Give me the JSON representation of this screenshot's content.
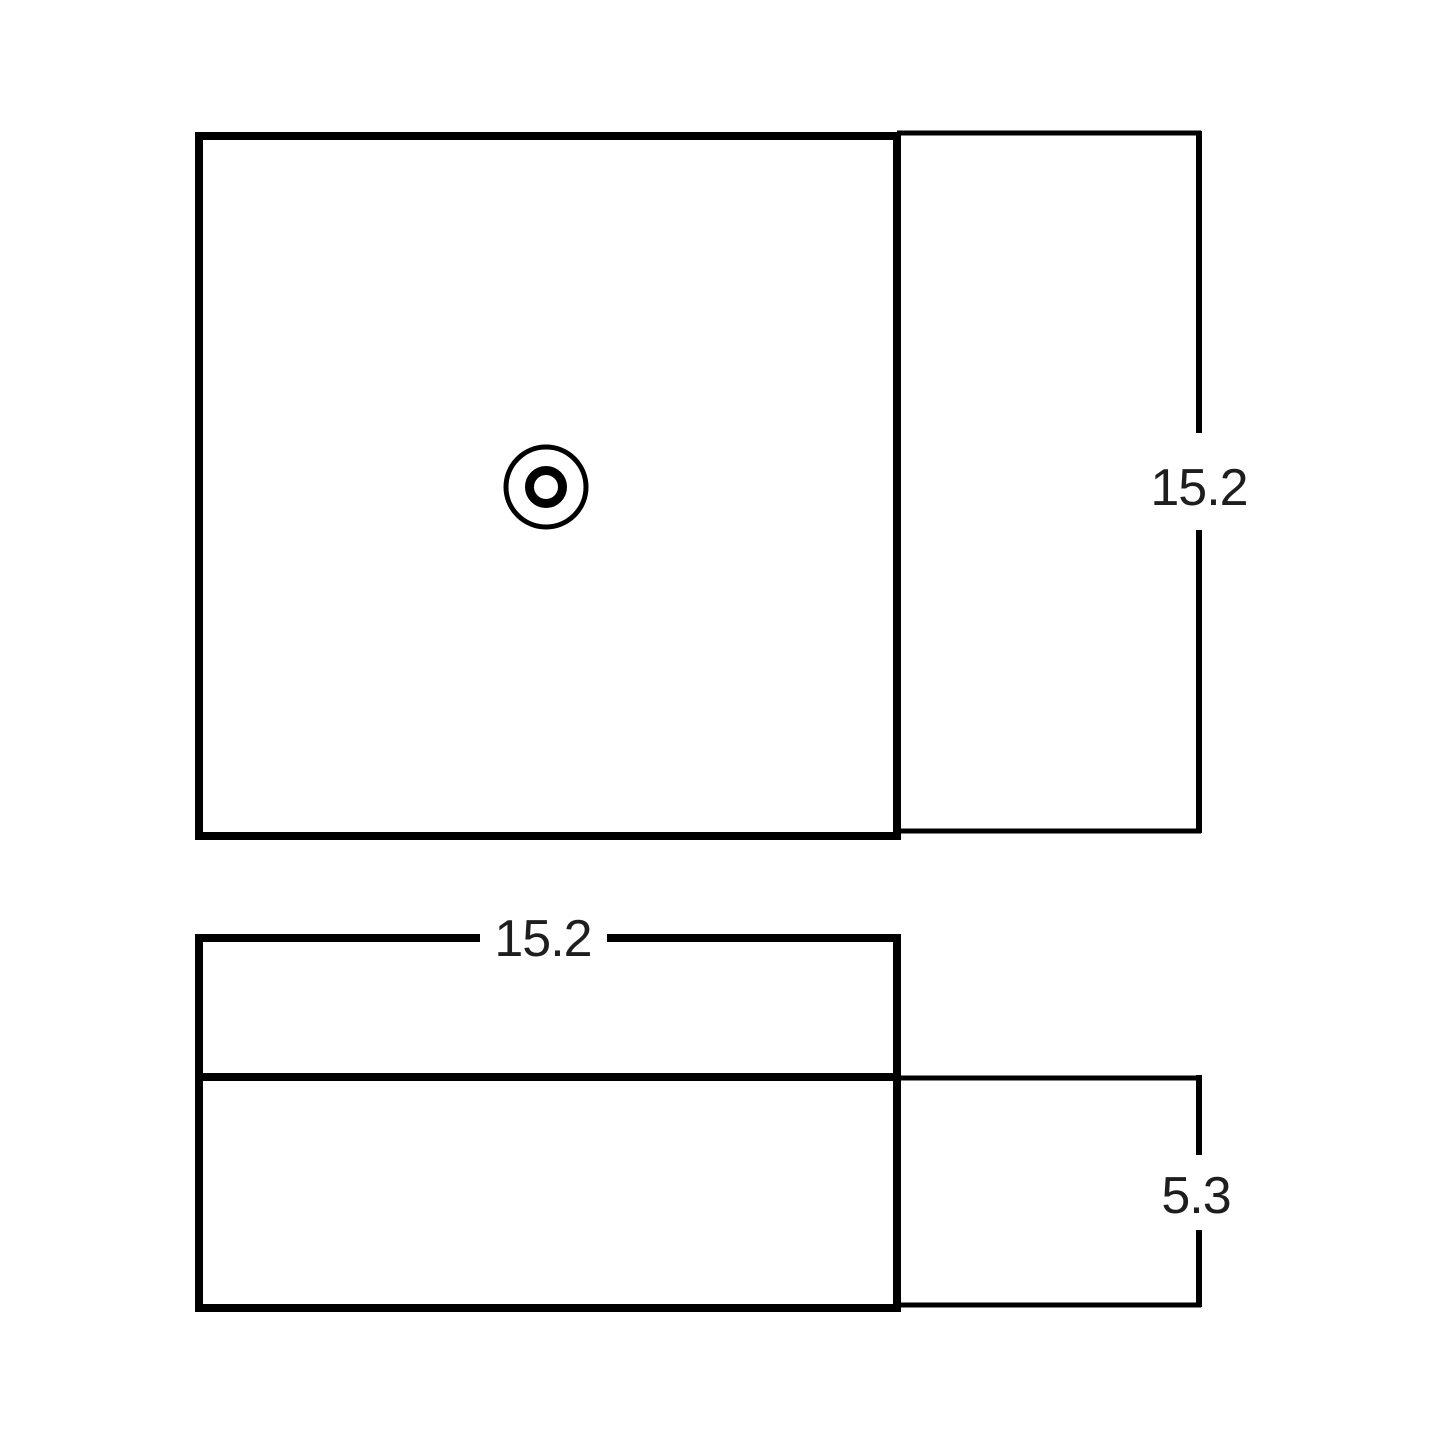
{
  "page": {
    "background_color": "#ffffff"
  },
  "drawing": {
    "stroke_color": "#000000",
    "text_color": "#1e1e1e",
    "top_view": {
      "depth_label": "15.2",
      "drain_icon": "concentric-circles-drain-hole"
    },
    "side_view": {
      "width_label": "15.2",
      "height_label": "5.3"
    },
    "dimensions": {
      "depth": "15.2",
      "width": "15.2",
      "height": "5.3"
    }
  }
}
